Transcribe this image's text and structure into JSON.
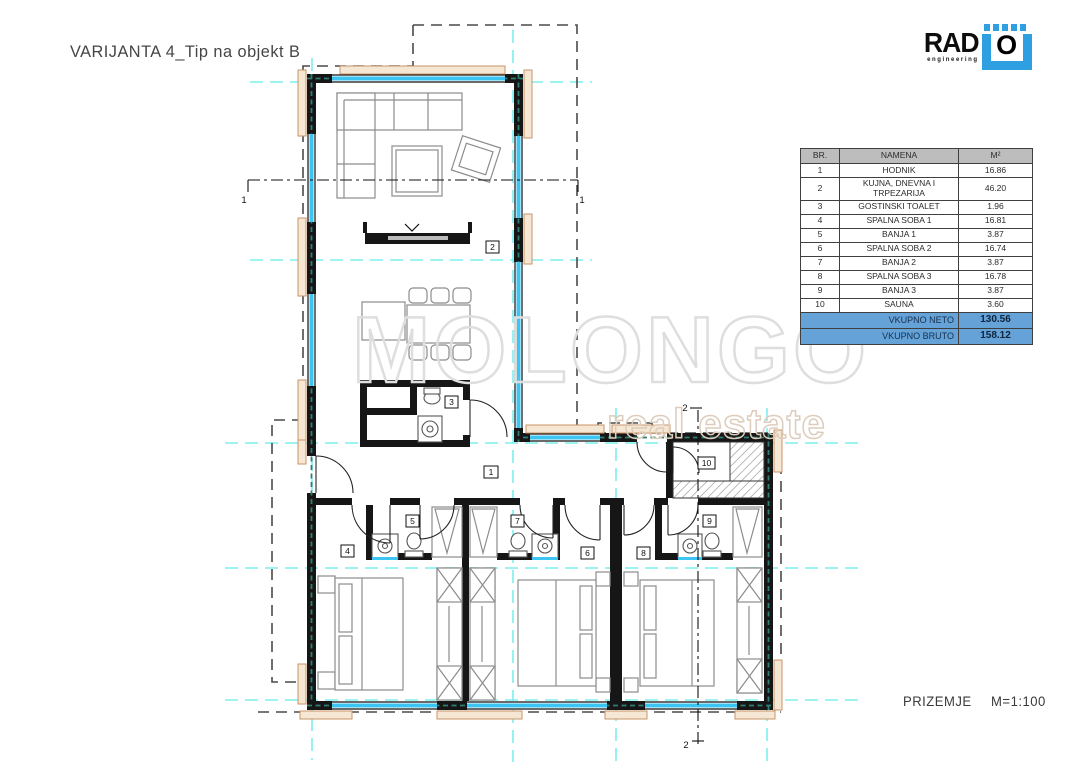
{
  "page": {
    "title": "VARIJANTA 4_Tip na objekt B",
    "plan_name": "PRIZEMJE",
    "scale": "M=1:100"
  },
  "logo": {
    "word": "RAD",
    "sub": "engineering",
    "letter": "O",
    "blue": "#2e9fe0"
  },
  "watermark": {
    "line1": "MOLONGO",
    "line2": "real estate"
  },
  "table": {
    "headers": {
      "br": "BR.",
      "name": "NAMENA",
      "area": "M²"
    },
    "rows": [
      {
        "br": "1",
        "name": "HODNIK",
        "area": "16.86"
      },
      {
        "br": "2",
        "name": "KUJNA, DNEVNA I TRPEZARIJA",
        "area": "46.20"
      },
      {
        "br": "3",
        "name": "GOSTINSKI TOALET",
        "area": "1.96"
      },
      {
        "br": "4",
        "name": "SPALNA SOBA 1",
        "area": "16.81"
      },
      {
        "br": "5",
        "name": "BANJA 1",
        "area": "3.87"
      },
      {
        "br": "6",
        "name": "SPALNA SOBA 2",
        "area": "16.74"
      },
      {
        "br": "7",
        "name": "BANJA 2",
        "area": "3.87"
      },
      {
        "br": "8",
        "name": "SPALNA SOBA 3",
        "area": "16.78"
      },
      {
        "br": "9",
        "name": "BANJA 3",
        "area": "3.87"
      },
      {
        "br": "10",
        "name": "SAUNA",
        "area": "3.60"
      }
    ],
    "totals": [
      {
        "label": "VKUPNO NETO",
        "value": "130.56"
      },
      {
        "label": "VKUPNO BRUTO",
        "value": "158.12"
      }
    ]
  },
  "plan": {
    "room_labels": [
      "1",
      "2",
      "3",
      "4",
      "5",
      "6",
      "7",
      "8",
      "9",
      "10"
    ],
    "section_labels": {
      "s1": "1",
      "s2": "2"
    },
    "colors": {
      "wall": "#161616",
      "window_glazing": "#3cc4f2",
      "grid_line": "#7deeee",
      "insulation": "#2f7e72",
      "trim": "#c89468",
      "roof_dash": "#4a4a4a",
      "furniture": "#8c8c8c",
      "totals_row_bg": "#64a2d8",
      "header_row_bg": "#bdbdbd"
    }
  }
}
